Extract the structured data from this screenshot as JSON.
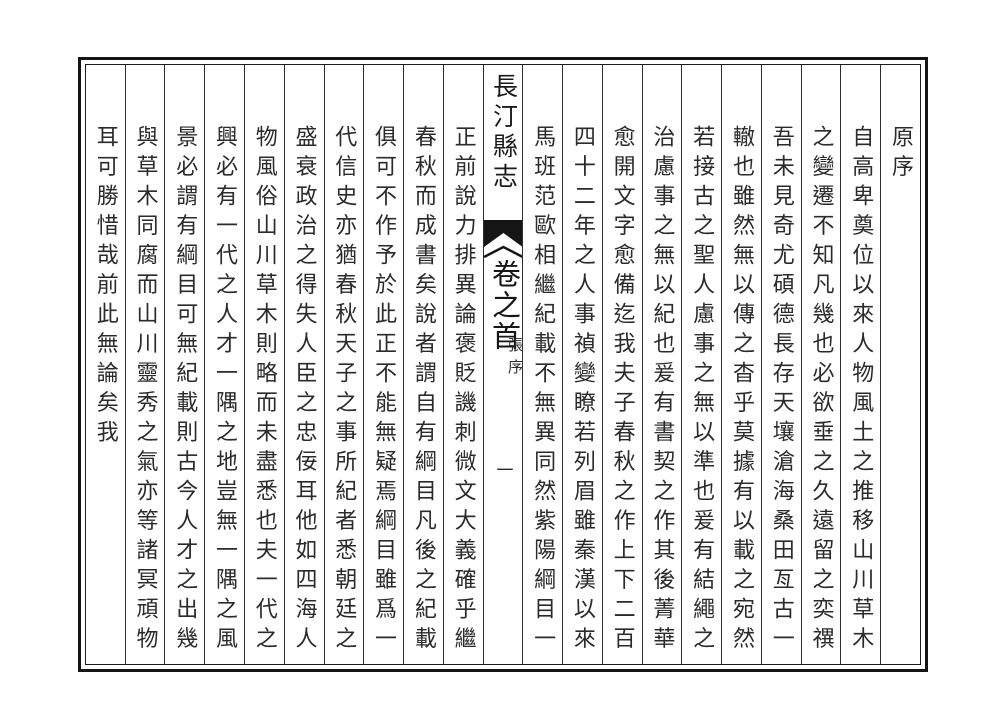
{
  "colors": {
    "ink": "#2b2b2b",
    "border": "#151515",
    "paper": "#ffffff"
  },
  "center_column": {
    "book_title": "長汀縣志",
    "volume_label": "卷之首",
    "section_label": "張序",
    "page_number": "一",
    "ornament": "fishtail-block"
  },
  "right_columns": [
    "原序",
    "自高卑奠位以來人物風土之推移山川草木",
    "之變遷不知凡幾也必欲垂之久遠留之奕禩",
    "吾未見奇尤碩德長存天壤滄海桑田亙古一",
    "轍也雖然無以傳之杳乎莫據有以載之宛然",
    "若接古之聖人慮事之無以準也爰有結繩之",
    "治慮事之無以紀也爰有書契之作其後菁華",
    "愈開文字愈備迄我夫子春秋之作上下二百",
    "四十二年之人事禎變瞭若列眉雖秦漢以來",
    "馬班范歐相繼紀載不無異同然紫陽綱目一"
  ],
  "left_columns": [
    "正前說力排異論褒貶譏刺微文大義確乎繼",
    "春秋而成書矣說者謂自有綱目凡後之紀載",
    "俱可不作予於此正不能無疑焉綱目雖爲一",
    "代信史亦猶春秋天子之事所紀者悉朝廷之",
    "盛衰政治之得失人臣之忠佞耳他如四海人",
    "物風俗山川草木則略而未盡悉也夫一代之",
    "興必有一代之人才一隅之地豈無一隅之風",
    "景必謂有綱目可無紀載則古今人才之出幾",
    "與草木同腐而山川靈秀之氣亦等諸冥頑物",
    "耳可勝惜哉前此無論矣我"
  ]
}
